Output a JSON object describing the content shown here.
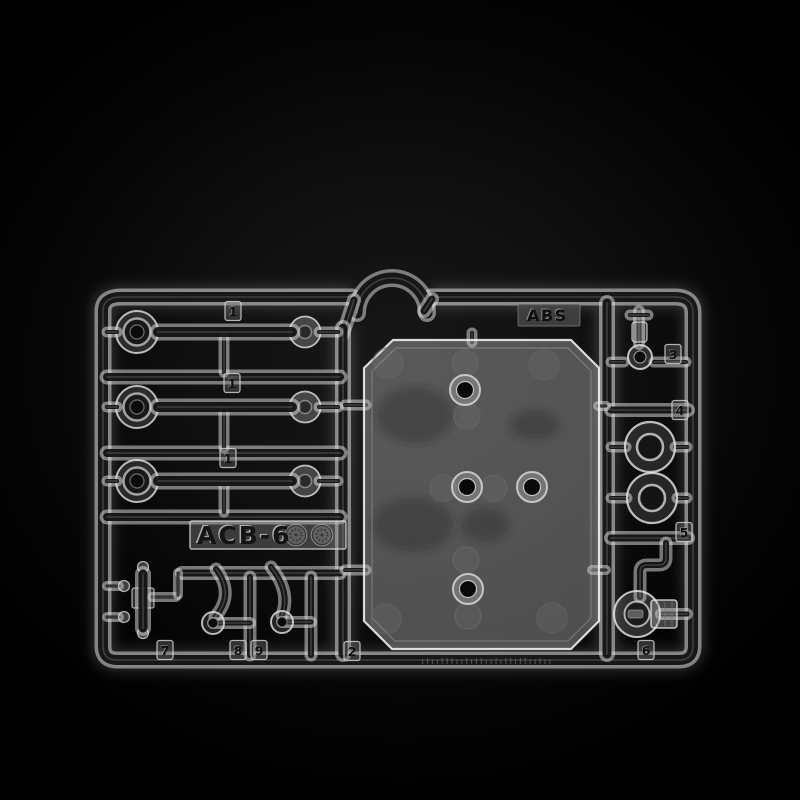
{
  "scene_label": "clear-plastic-model-kit-sprue-on-black",
  "markings": {
    "kit_code": "ACB-6",
    "material": "ABS",
    "footer_glyphs": "ılıılllıılıllıılıllıllıılıı"
  },
  "part_numbers": [
    "1",
    "1",
    "1",
    "2",
    "3",
    "4",
    "5",
    "6",
    "7",
    "8",
    "9"
  ],
  "symbols": [
    {
      "name": "molded-recycle-symbol"
    },
    {
      "name": "molded-recycle-symbol"
    }
  ],
  "colors": {
    "background": "#000000",
    "plastic_highlight": "#dedede",
    "plastic_core": "#101010",
    "plate_tint": "#bcbcbc"
  }
}
